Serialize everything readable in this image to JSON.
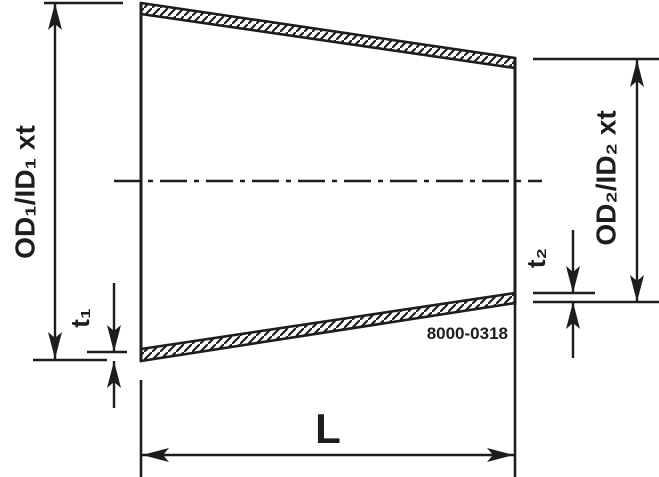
{
  "drawing": {
    "drawing_number": "8000-0318",
    "labels": {
      "od1": "OD₁/ID₁ xt",
      "t1": "t₁",
      "od2": "OD₂/ID₂ xt",
      "t2": "t₂",
      "length": "L"
    },
    "colors": {
      "ink": "#1d1d1b",
      "background": "#ffffff"
    }
  }
}
